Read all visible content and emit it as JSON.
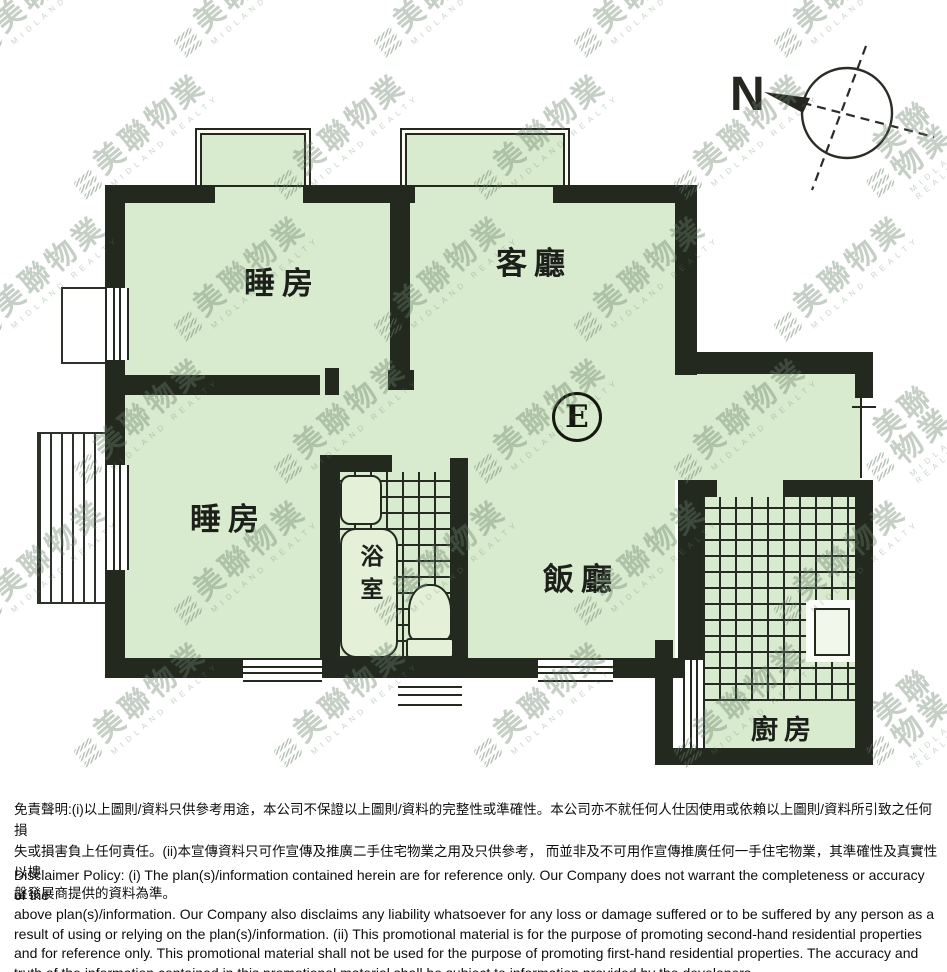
{
  "plan": {
    "rooms": {
      "bedroom_top": {
        "label": "睡房"
      },
      "living_room": {
        "label": "客廳"
      },
      "bedroom_left": {
        "label": "睡房"
      },
      "bathroom": {
        "label": "浴室"
      },
      "dining_room": {
        "label": "飯廳"
      },
      "kitchen": {
        "label": "廚房"
      }
    },
    "unit_marker": "E",
    "compass_label": "N"
  },
  "watermark": {
    "text": "美聯物業",
    "subtext": "MIDLAND REALTY",
    "rows": 6,
    "cols": 5
  },
  "colors": {
    "room_fill": "#d9ebce",
    "wall": "#23291f",
    "watermark": "rgba(104,128,104,0.38)"
  },
  "disclaimer": {
    "chinese": "免責聲明:(i)以上圖則/資料只供參考用途，本公司不保證以上圖則/資料的完整性或準確性。本公司亦不就任何人仕因使用或依賴以上圖則/資料所引致之任何損\n失或損害負上任何責任。(ii)本宣傳資料只可作宣傳及推廣二手住宅物業之用及只供參考， 而並非及不可用作宣傳推廣任何一手住宅物業，其準確性及真實性以樓\n盤發展商提供的資料為準。",
    "english": "Disclaimer Policy: (i) The plan(s)/information contained herein are for reference only. Our Company does not warrant the completeness or accuracy of the\nabove plan(s)/information. Our Company also disclaims any liability whatsoever for any loss or damage suffered or to be suffered by any person as a\nresult of using or relying on the plan(s)/information. (ii) This promotional material is for the purpose of promoting second-hand residential properties\nand for reference only. This promotional material shall not be used for the purpose of promoting first-hand residential properties. The accuracy and\ntruth of the information contained in this promotional material shall be subject to information provided by the developers."
  }
}
